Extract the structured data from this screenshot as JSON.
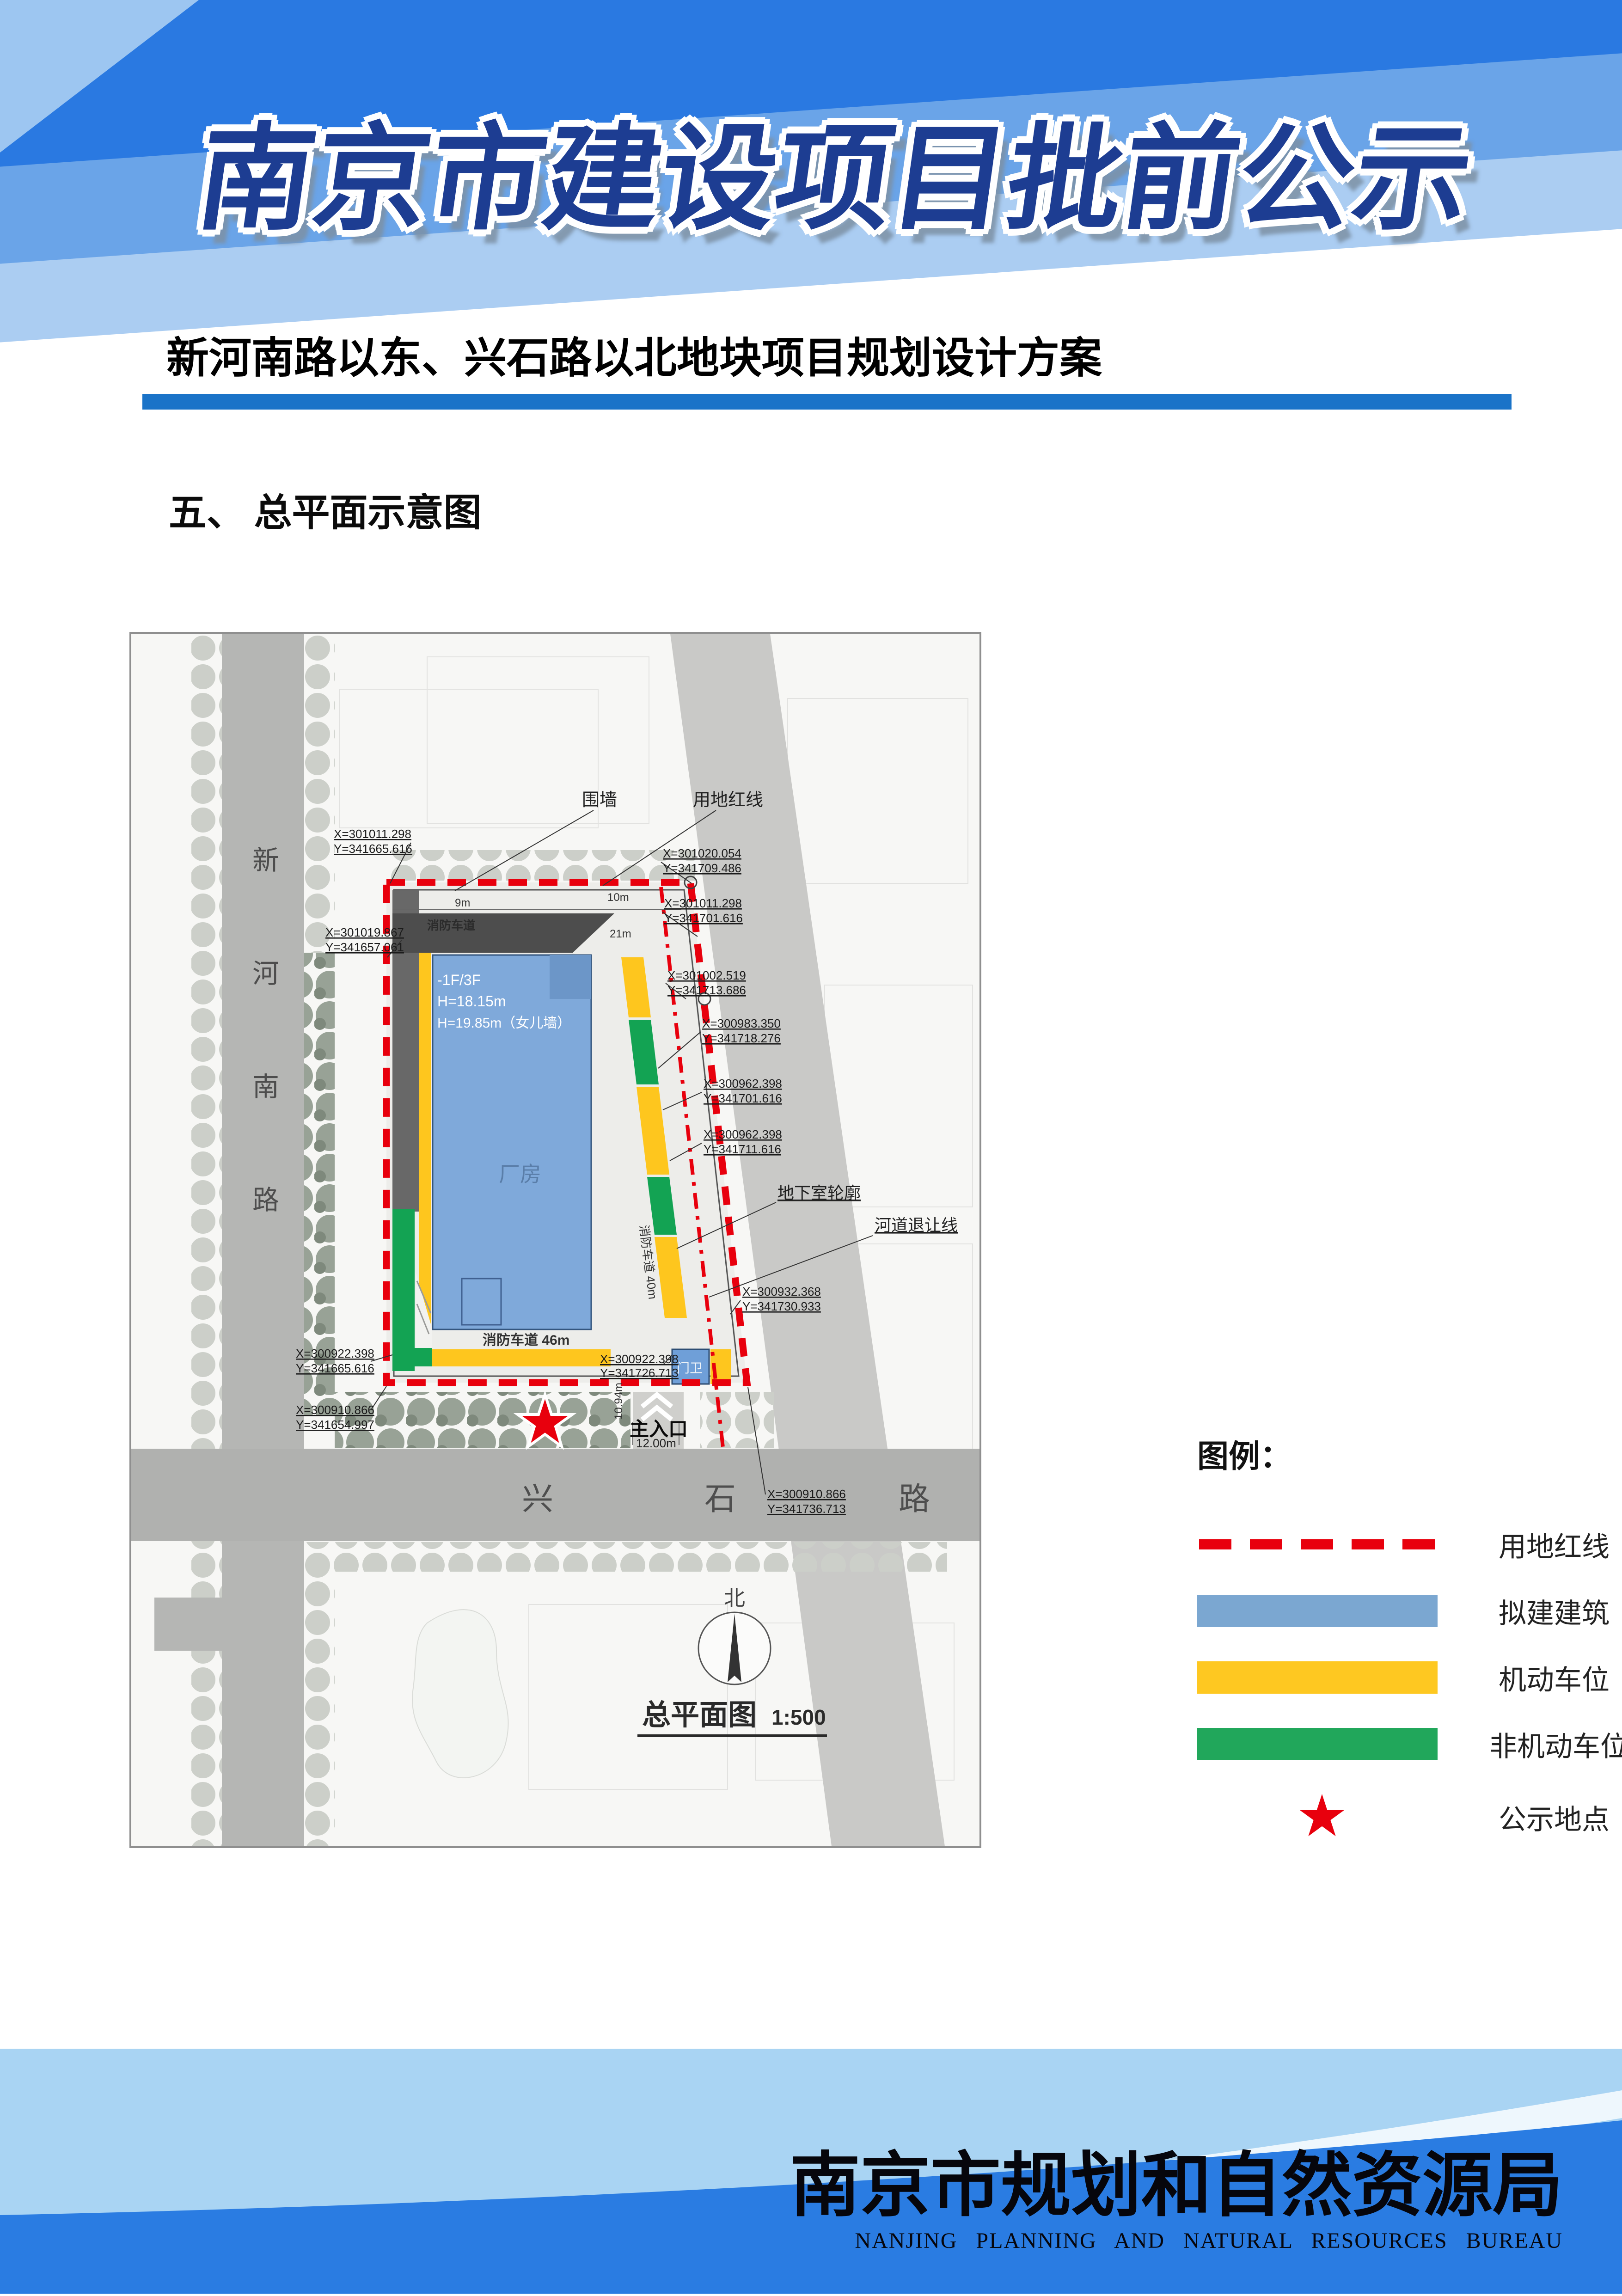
{
  "header": {
    "title": "南京市建设项目批前公示"
  },
  "project": {
    "subtitle": "新河南路以东、兴石路以北地块项目规划设计方案",
    "section_heading": "五、 总平面示意图"
  },
  "map": {
    "plan_title": "总平面图",
    "plan_scale": "1:500",
    "north_label": "北",
    "roads": {
      "west_chars": [
        "新",
        "河",
        "南",
        "路"
      ],
      "south_chars": [
        "兴",
        "石",
        "路"
      ]
    },
    "building": {
      "name": "厂房",
      "floors": "-1F/3F",
      "height_main": "H=18.15m",
      "height_parapet": "H=19.85m（女儿墙）",
      "guard": "门卫"
    },
    "labels": {
      "fence": "围墙",
      "red_line": "用地红线",
      "basement_outline": "地下室轮廓",
      "river_setback": "河道退让线",
      "fire_lane_46": "消防车道 46m",
      "fire_lane_40": "消防车道 40m",
      "fire_lane": "消防车道",
      "main_entrance": "主入口"
    },
    "dims": {
      "w9": "9m",
      "w10": "10m",
      "w21": "21m",
      "h1094": "10.94m",
      "entrance": "12.00m"
    },
    "coords": [
      {
        "x": "X=301011.298",
        "y": "Y=341665.616"
      },
      {
        "x": "X=301019.867",
        "y": "Y=341657.061"
      },
      {
        "x": "X=301020.054",
        "y": "Y=341709.486"
      },
      {
        "x": "X=301011.298",
        "y": "Y=341701.616"
      },
      {
        "x": "X=301002.519",
        "y": "Y=341713.686"
      },
      {
        "x": "X=300983.350",
        "y": "Y=341718.276"
      },
      {
        "x": "X=300962.398",
        "y": "Y=341701.616"
      },
      {
        "x": "X=300962.398",
        "y": "Y=341711.616"
      },
      {
        "x": "X=300932.368",
        "y": "Y=341730.933"
      },
      {
        "x": "X=300922.398",
        "y": "Y=341726.713"
      },
      {
        "x": "X=300922.398",
        "y": "Y=341665.616"
      },
      {
        "x": "X=300910.866",
        "y": "Y=341654.997"
      },
      {
        "x": "X=300910.866",
        "y": "Y=341736.713"
      }
    ]
  },
  "legend": {
    "title": "图例：",
    "colors": {
      "red": "#e8000d",
      "blue": "#7ba7d1",
      "yellow": "#fec821",
      "green": "#21a75b"
    },
    "items": [
      {
        "label": "用地红线"
      },
      {
        "label": "拟建建筑"
      },
      {
        "label": "机动车位"
      },
      {
        "label": "非机动车位"
      },
      {
        "label": "公示地点"
      }
    ]
  },
  "footer": {
    "org_cn": "南京市规划和自然资源局",
    "org_en": "NANJING PLANNING AND NATURAL RESOURCES BUREAU"
  }
}
